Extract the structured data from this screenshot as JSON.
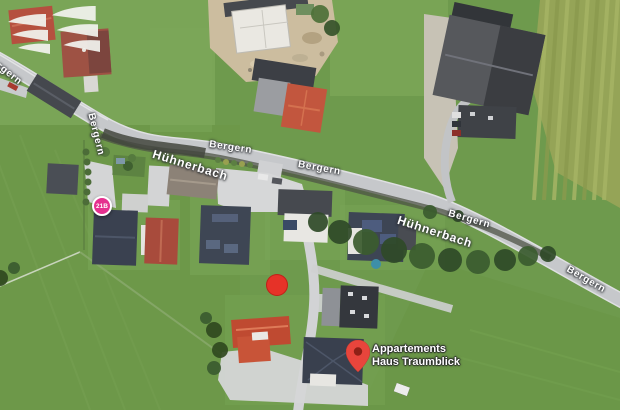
{
  "map": {
    "street_names": {
      "bergern": "Bergern",
      "huehnerbach": "Hühnerbach"
    },
    "poi": {
      "line1": "Appartements",
      "line2": "Haus Traumblick"
    },
    "badge": {
      "text": "21B"
    },
    "markers": {
      "pin_color": "#e8453c",
      "pin_icon": "map-pin",
      "dot_color": "#e63228",
      "badge_color": "#e5308f"
    },
    "watermark_icon": "double-wings-logo",
    "imagery_type": "satellite"
  }
}
